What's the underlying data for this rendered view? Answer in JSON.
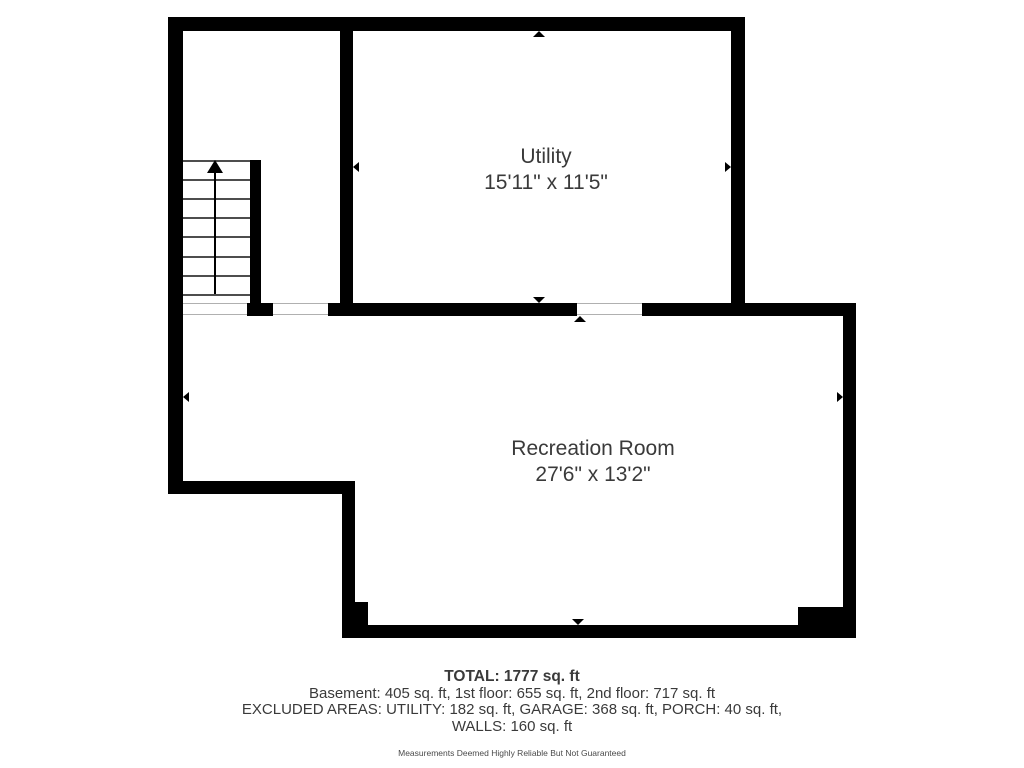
{
  "floorplan": {
    "rooms": [
      {
        "name": "Utility",
        "dimensions": "15'11\" x 11'5\""
      },
      {
        "name": "Recreation Room",
        "dimensions": "27'6\" x 13'2\""
      }
    ],
    "stairs": {
      "direction": "up",
      "treads": 7
    }
  },
  "summary": {
    "total": "TOTAL: 1777 sq. ft",
    "floors": "Basement: 405 sq. ft, 1st floor: 655 sq. ft, 2nd floor: 717 sq. ft",
    "excluded_areas": "EXCLUDED AREAS: UTILITY: 182 sq. ft, GARAGE: 368 sq. ft, PORCH: 40 sq. ft,",
    "walls": "WALLS: 160 sq. ft",
    "disclaimer": "Measurements Deemed Highly Reliable But Not Guaranteed"
  },
  "colors": {
    "wall": "#000000",
    "text": "#3a3a3a",
    "tread_line": "#4d4d4d",
    "threshold_line": "#b0b0b0"
  }
}
